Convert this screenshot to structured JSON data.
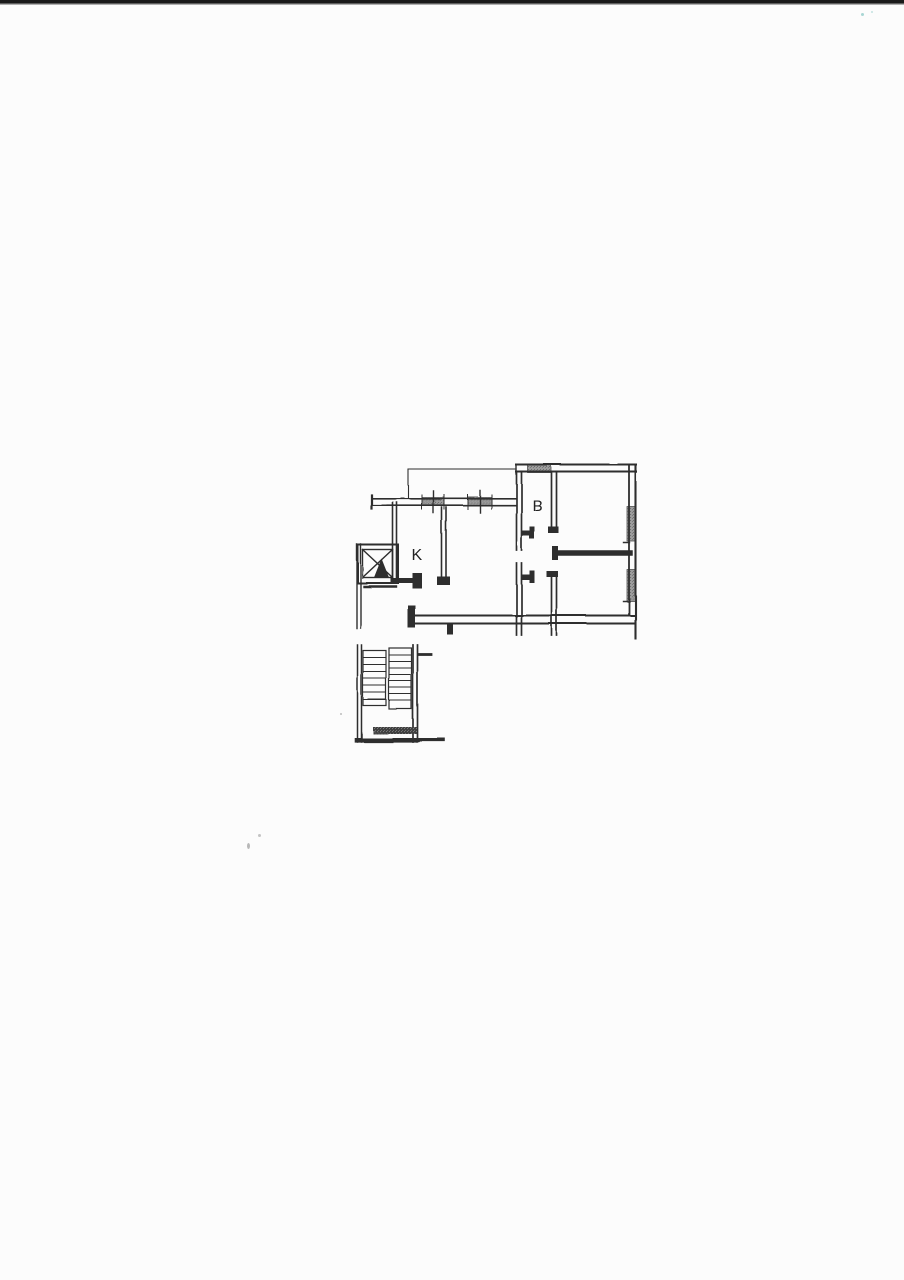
{
  "page": {
    "background_color": "#fcfcfc",
    "scanner_edge_color": "#1a1a1a"
  },
  "floorplan": {
    "kind": "scanned apartment floor plan with staircase and elevator shaft",
    "line_color": "#2d2d2d",
    "window_fill": "#9c9c9c",
    "stair_strip_color": "#3f3f3f",
    "rooms": [
      {
        "id": "kitchen",
        "label": "K"
      },
      {
        "id": "bath",
        "label": "B"
      }
    ]
  }
}
